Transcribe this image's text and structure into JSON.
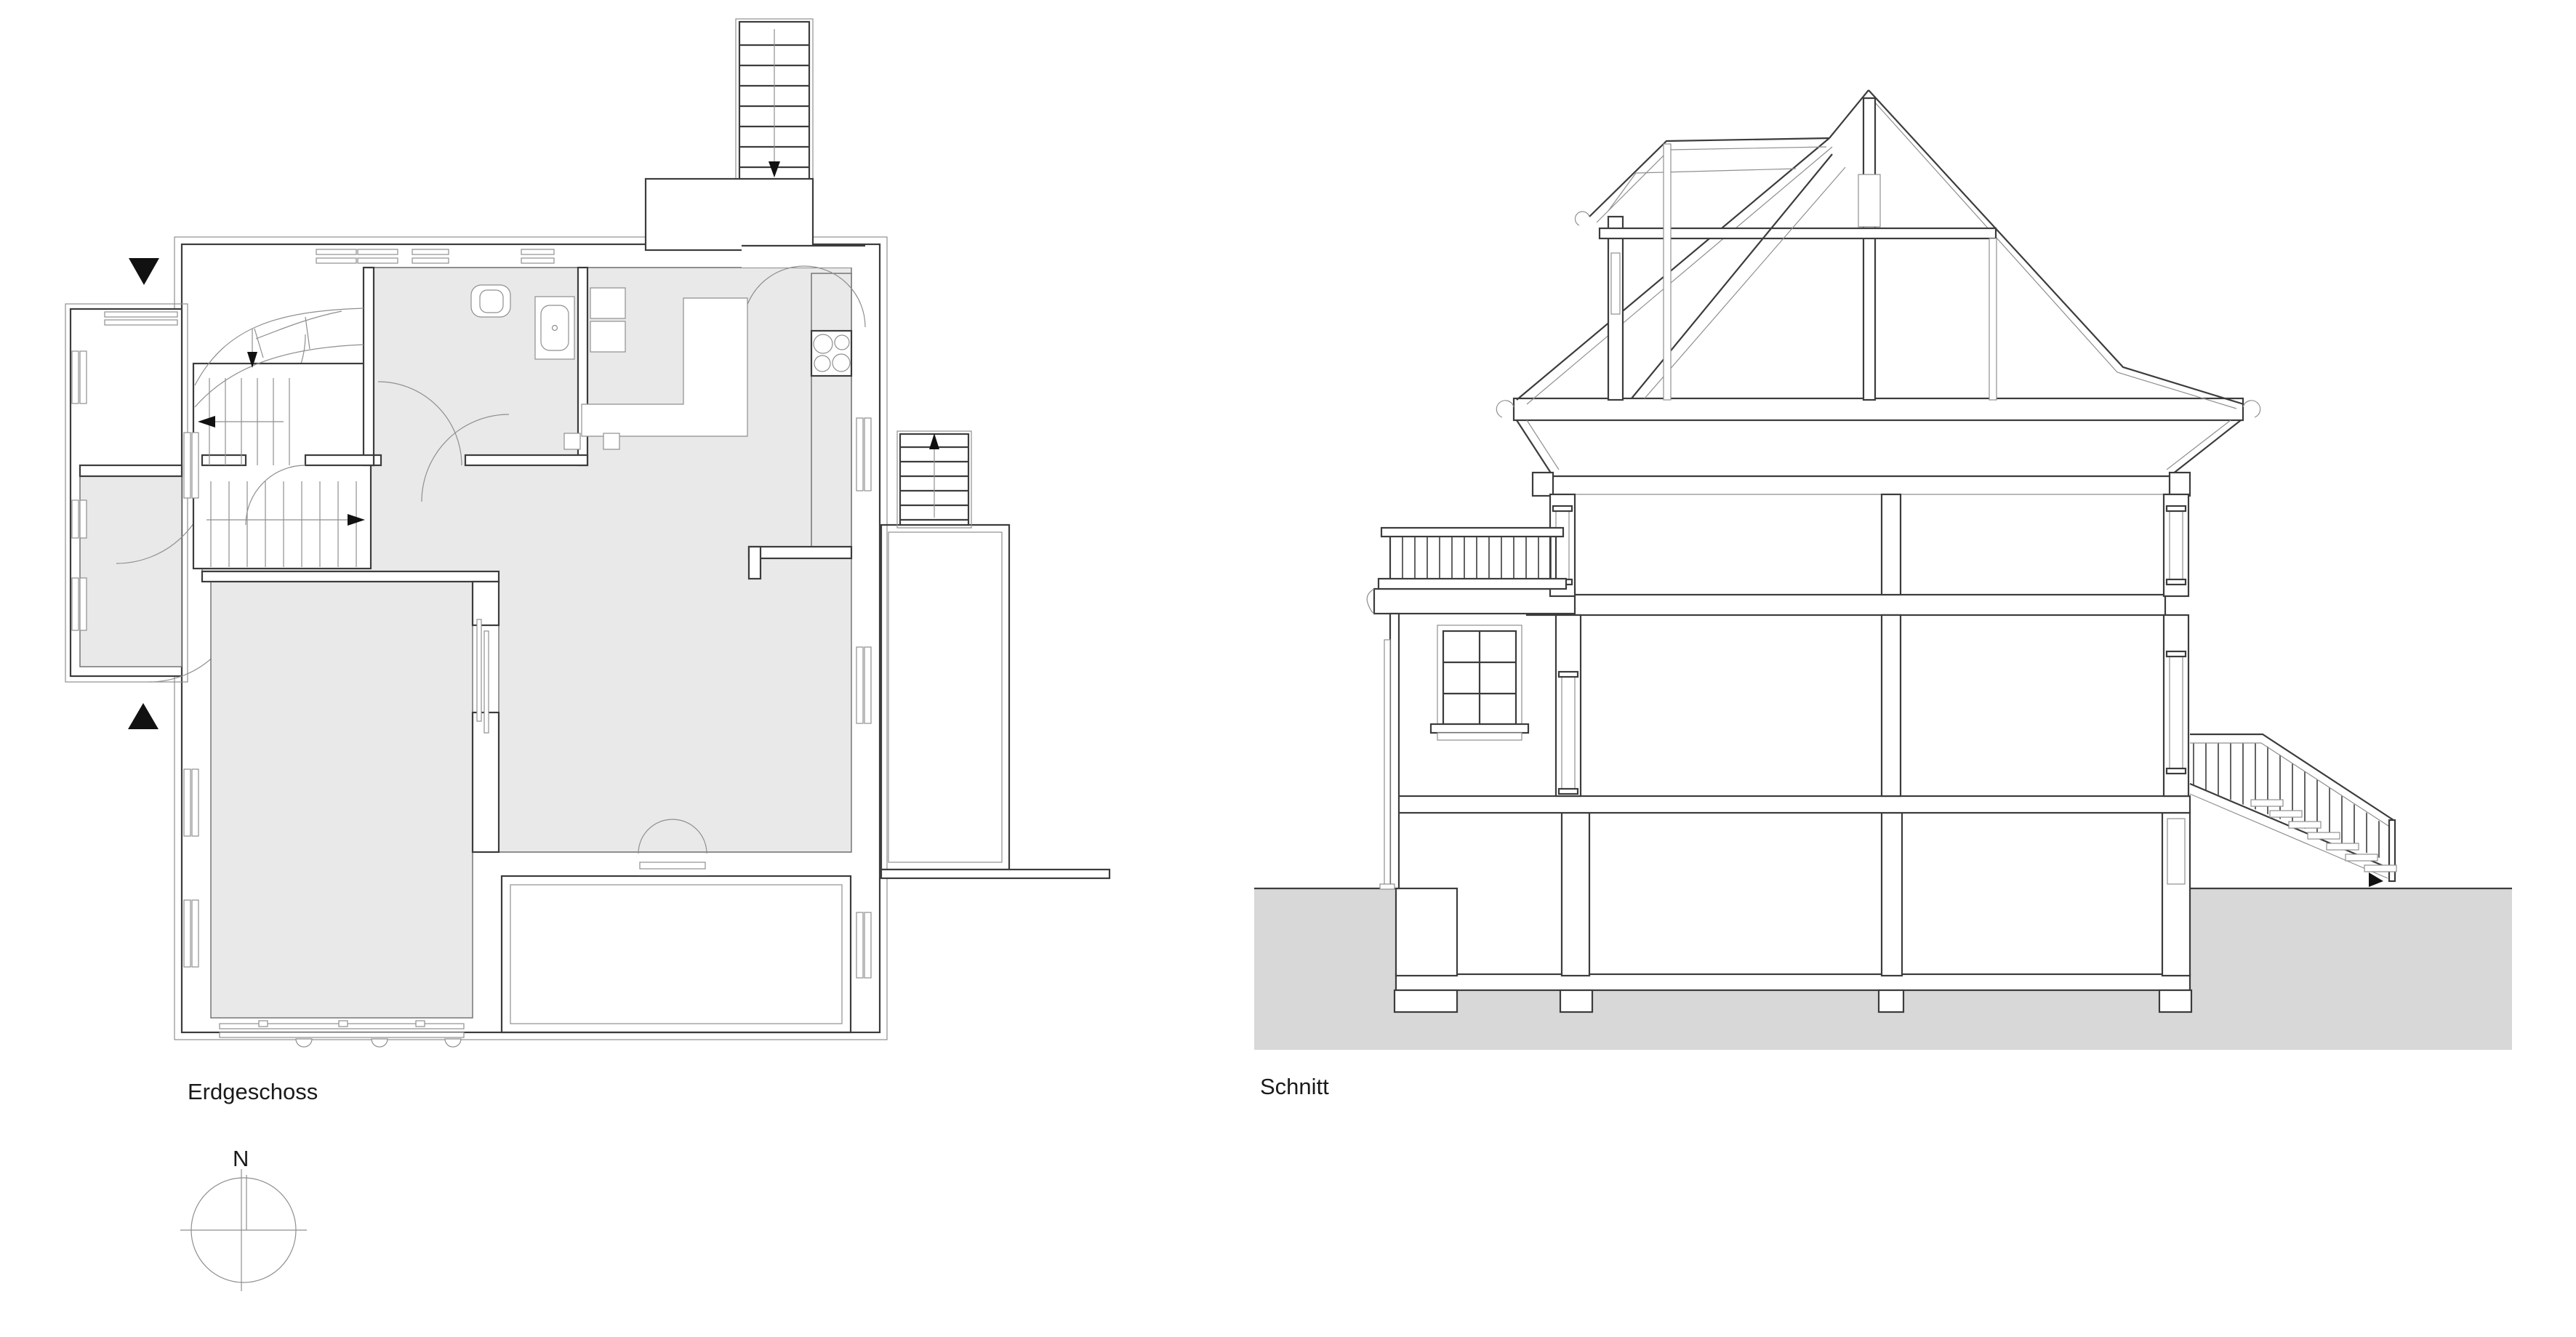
{
  "sheet": {
    "type": "architectural-drawing",
    "background": "#ffffff"
  },
  "colors": {
    "line_dark": "#3c3c3c",
    "line_light": "#8f8f8f",
    "room_fill": "#e9e9e9",
    "ground_fill": "#d8d8d8",
    "tile_line": "#d6d6d6",
    "marker_black": "#111111",
    "text": "#1a1a1a"
  },
  "floor_plan": {
    "label": "Erdgeschoss",
    "compass": {
      "label": "N"
    },
    "elements": [
      "entry-porch",
      "vestibule",
      "interior-stair",
      "winder-stair",
      "bathroom",
      "toilet",
      "sink",
      "kitchen",
      "kitchen-island",
      "stove",
      "oven-tower",
      "living-room",
      "room-southwest",
      "bay-window",
      "south-terrace",
      "east-terrace",
      "east-exterior-stair",
      "top-exterior-stair",
      "section-cut-markers",
      "windows",
      "door-swings"
    ]
  },
  "section": {
    "label": "Schnitt",
    "elements": [
      "roof-truss",
      "king-post",
      "collar-beam",
      "dormer",
      "gutters",
      "attic-floor",
      "upper-floor",
      "ground-floor",
      "basement",
      "footings",
      "balcony-balustrade",
      "facade-window",
      "downpipe",
      "exterior-stair-railing",
      "exterior-stair-treads",
      "ground-poche"
    ]
  }
}
